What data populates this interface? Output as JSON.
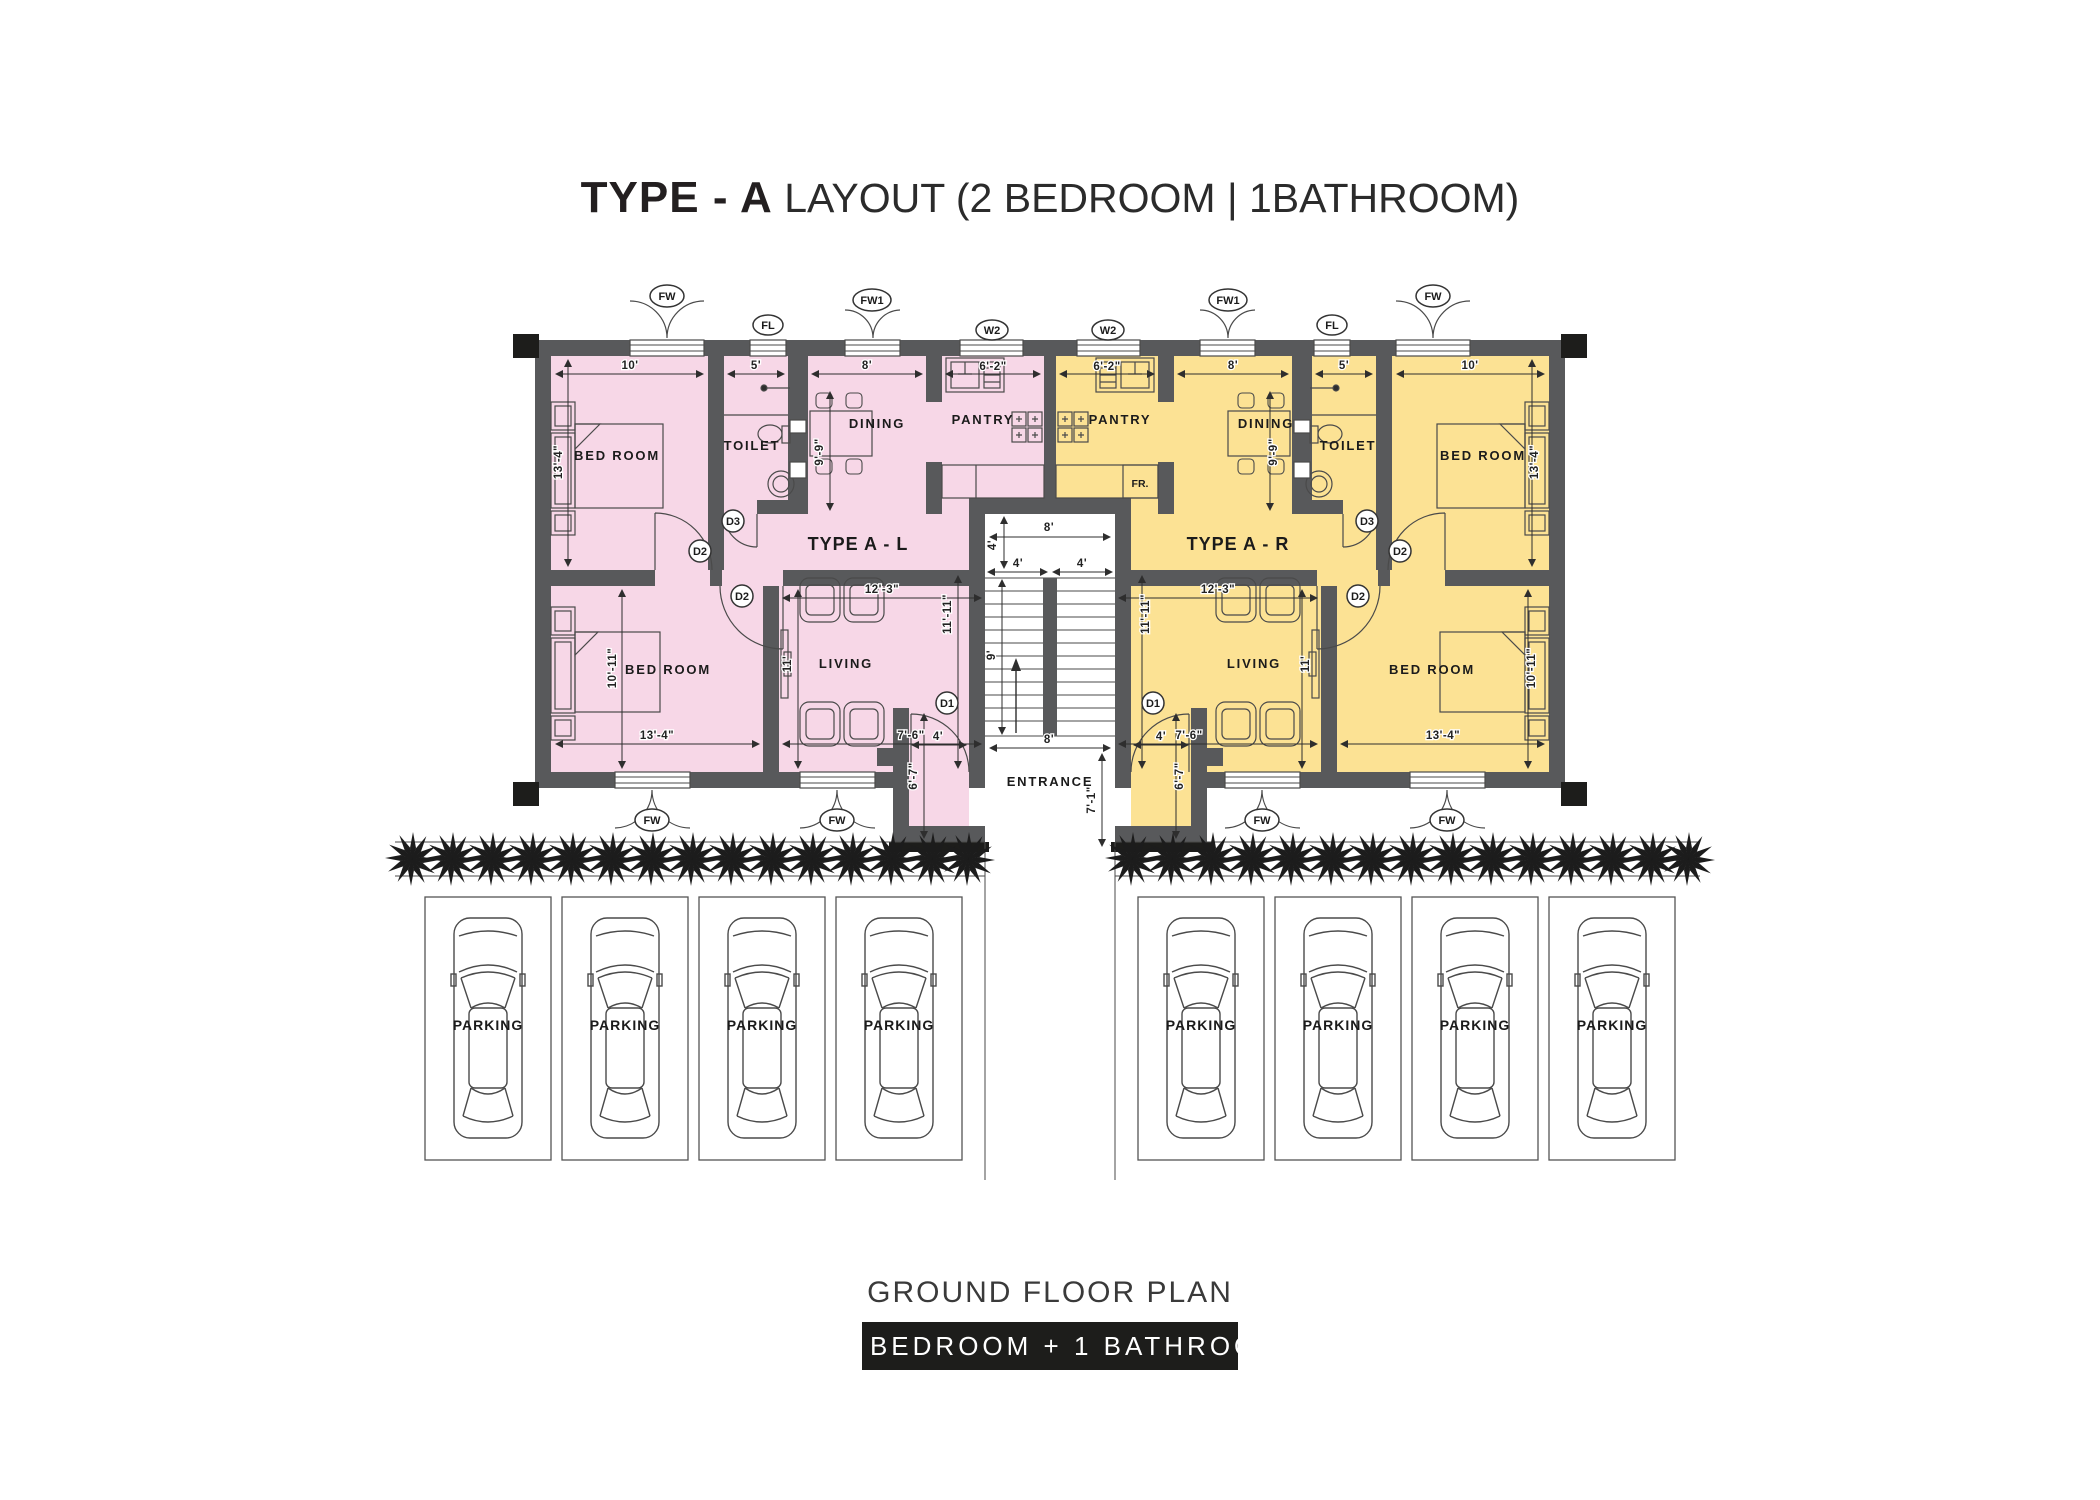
{
  "title": {
    "bold": "TYPE - A",
    "rest": " LAYOUT (2 BEDROOM | 1BATHROOM)"
  },
  "units": {
    "left_name": "TYPE A - L",
    "right_name": "TYPE A - R"
  },
  "rooms": {
    "bedroom": "BED ROOM",
    "toilet": "TOILET",
    "dining": "DINING",
    "pantry": "PANTRY",
    "living": "LIVING",
    "entrance": "ENTRANCE",
    "fridge": "FR."
  },
  "openings": {
    "fw": "FW",
    "fw1": "FW1",
    "fl": "FL",
    "w2": "W2",
    "d1": "D1",
    "d2": "D2",
    "d3": "D3"
  },
  "dims": {
    "d10": "10'",
    "d5": "5'",
    "d8": "8'",
    "d6_2": "6'-2\"",
    "d13_4": "13'-4\"",
    "d9_9": "9'-9\"",
    "d10_11": "10'-11\"",
    "d12_3": "12'-3\"",
    "d11": "11'",
    "d7_6": "7'-6\"",
    "d11_11": "11'-11\"",
    "d4": "4'",
    "d9": "9'",
    "d6_7": "6'-7\"",
    "d7_1": "7'-1\""
  },
  "parking": {
    "label": "PARKING",
    "count_left": 4,
    "count_right": 4
  },
  "footer": {
    "caption": "GROUND FLOOR PLAN",
    "badge": "O2 BEDROOM + 1 BATHROOM"
  },
  "colors": {
    "left_unit": "#f7d7e7",
    "right_unit": "#fce294",
    "wall": "#58595b",
    "accent_black": "#1d1d1b"
  }
}
